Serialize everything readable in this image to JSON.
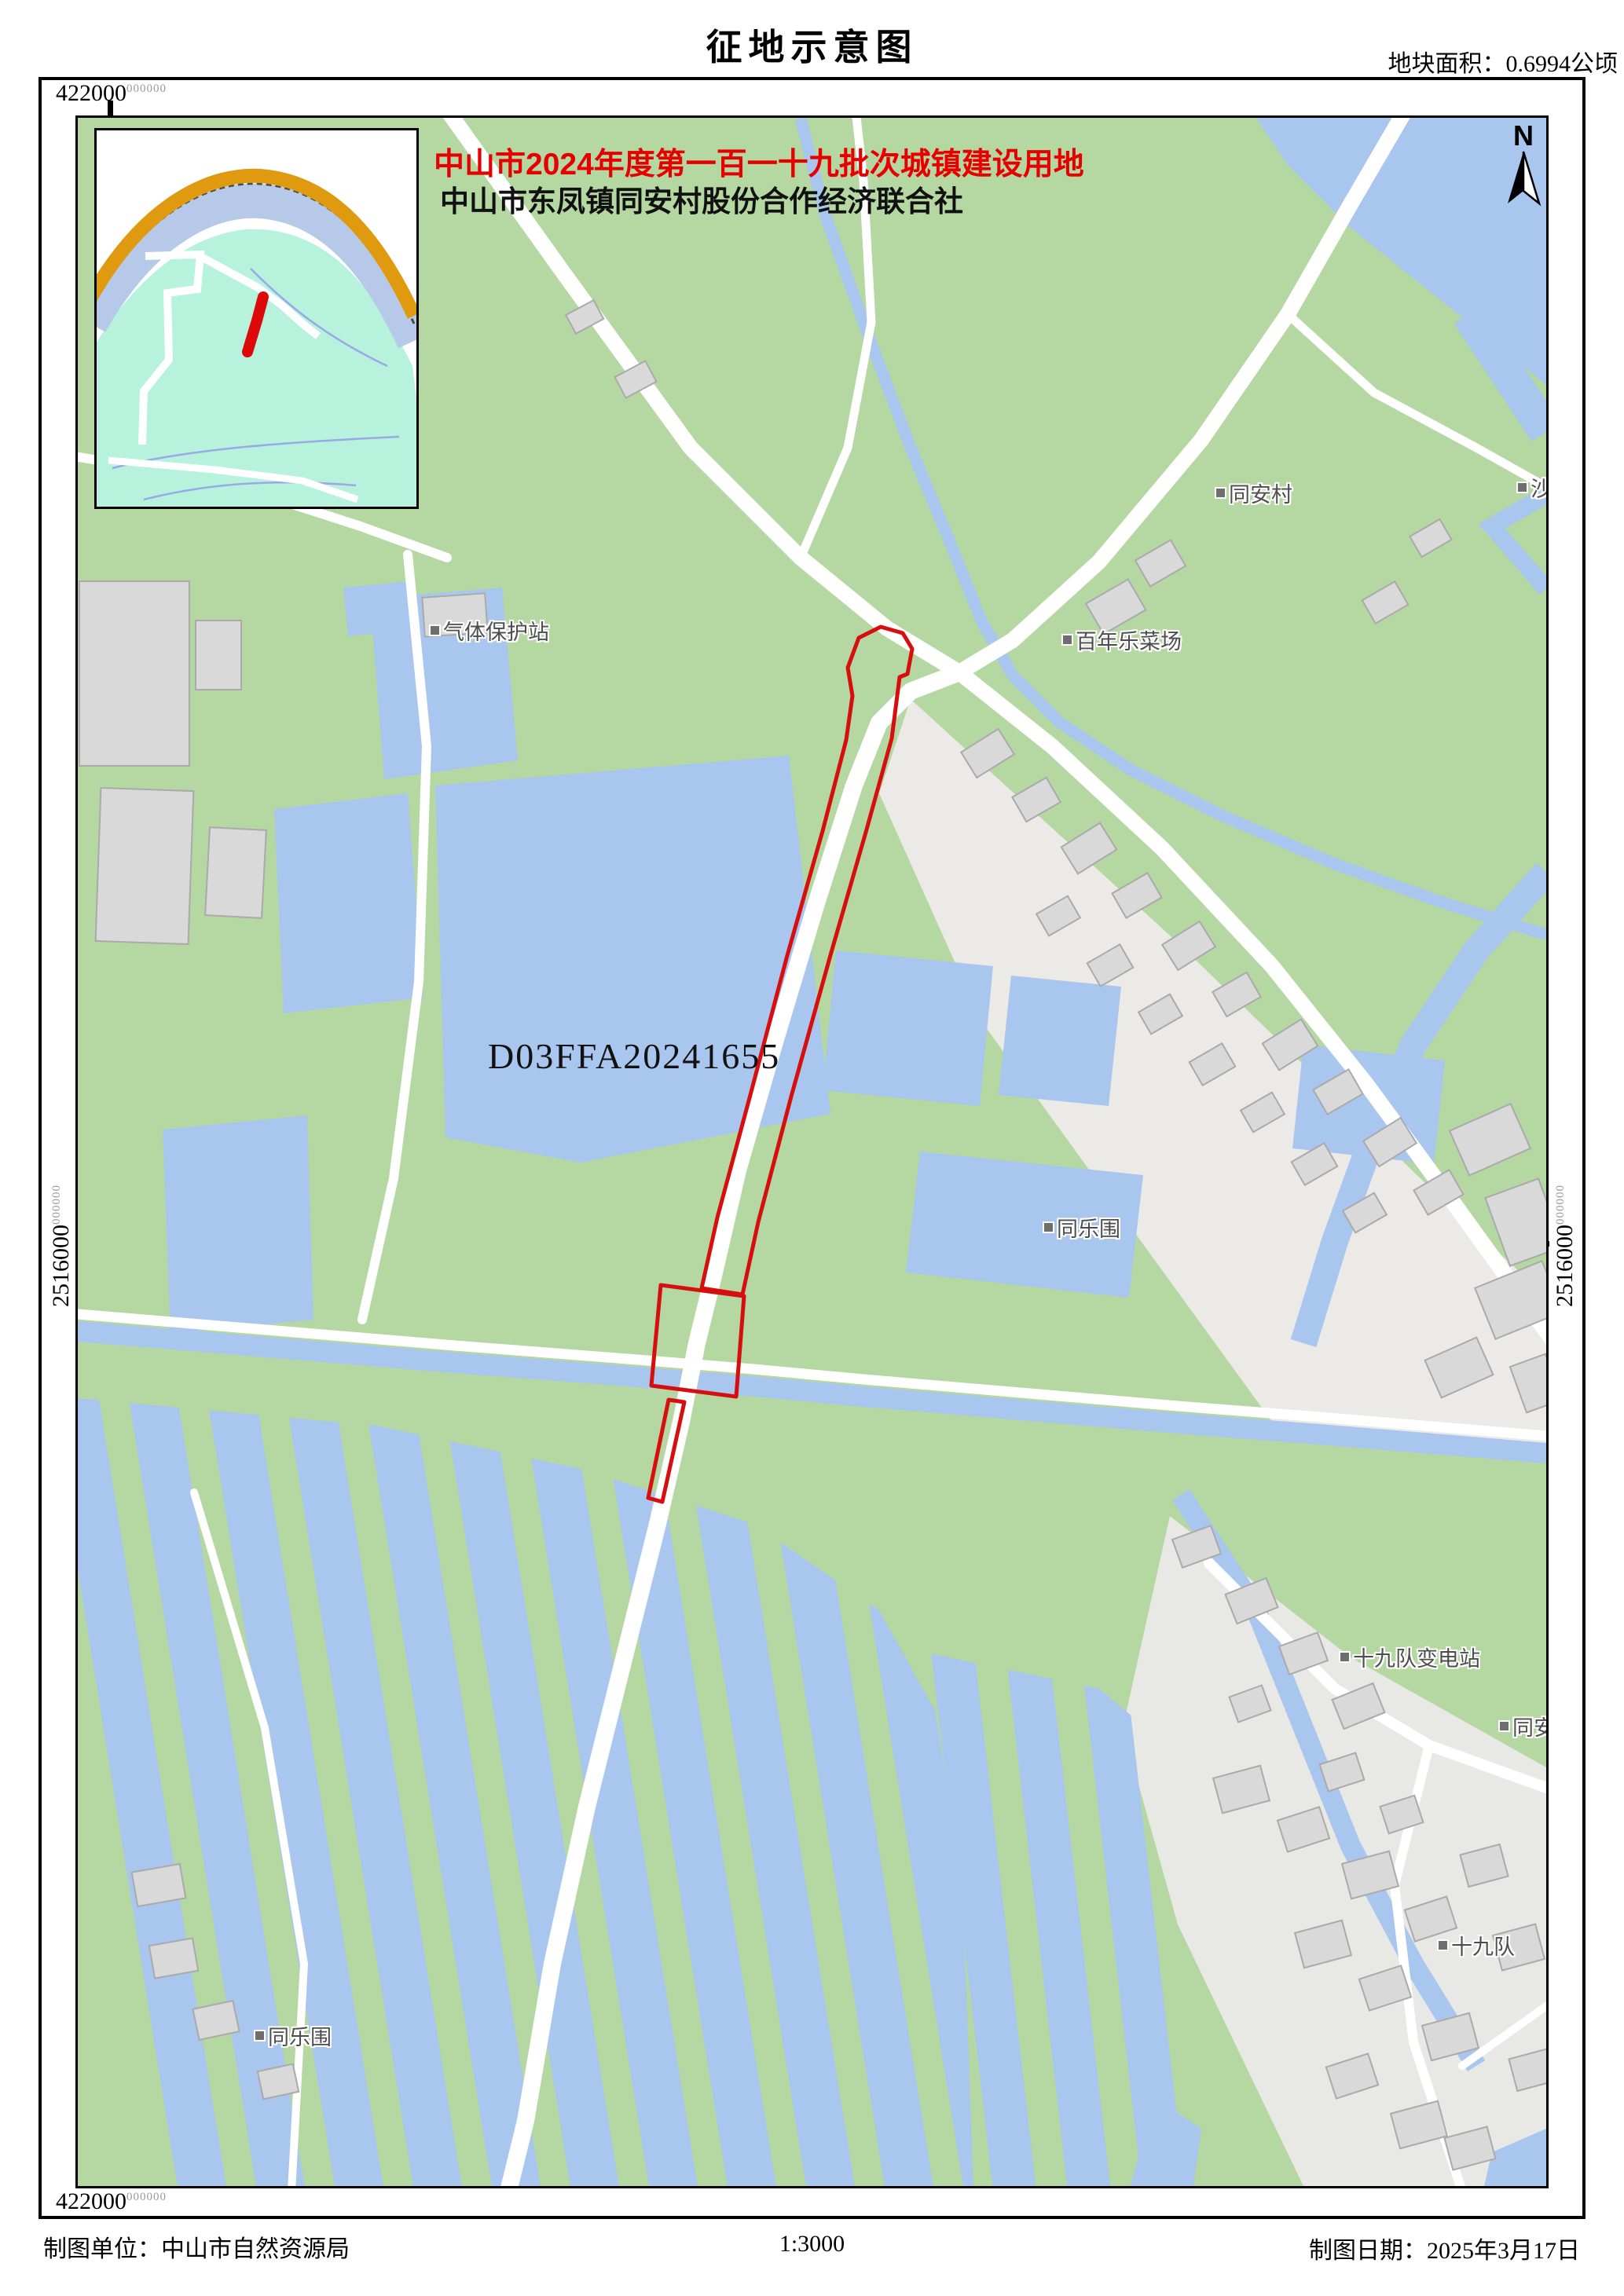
{
  "title": "征地示意图",
  "area_note": "地块面积：0.6994公顷",
  "annotation": {
    "line1": "中山市2024年度第一百一十九批次城镇建设用地",
    "line2": "中山市东凤镇同安村股份合作经济联合社"
  },
  "parcel_code": "D03FFA20241655",
  "compass_n": "N",
  "coords": {
    "x_top": "422000",
    "x_bottom": "422000",
    "y_left": "2516000",
    "y_right": "2516000",
    "frac": "000000"
  },
  "map_labels": {
    "tongancun": "同安村",
    "sha": "沙",
    "qiti_station": "气体保护站",
    "bainianle_market": "百年乐菜场",
    "tonglewei_mid": "同乐围",
    "shijiudui_substation": "十九队变电站",
    "tongan_edge": "同安",
    "shijiudui": "十九队",
    "tonglewei_bottom": "同乐围"
  },
  "footer": {
    "agency": "制图单位：中山市自然资源局",
    "scale": "1:3000",
    "date": "制图日期：2025年3月17日"
  },
  "colors": {
    "land_green": "#b5d7a2",
    "water_blue": "#a9c6ee",
    "building_gray": "#d9d9d9",
    "road_white": "#ffffff",
    "parcel_red": "#d60e0e",
    "annotation_red": "#e60000",
    "inset_mint": "#b6f2dc",
    "inset_orange": "#e09a10",
    "inset_river": "#b7c9e8"
  }
}
